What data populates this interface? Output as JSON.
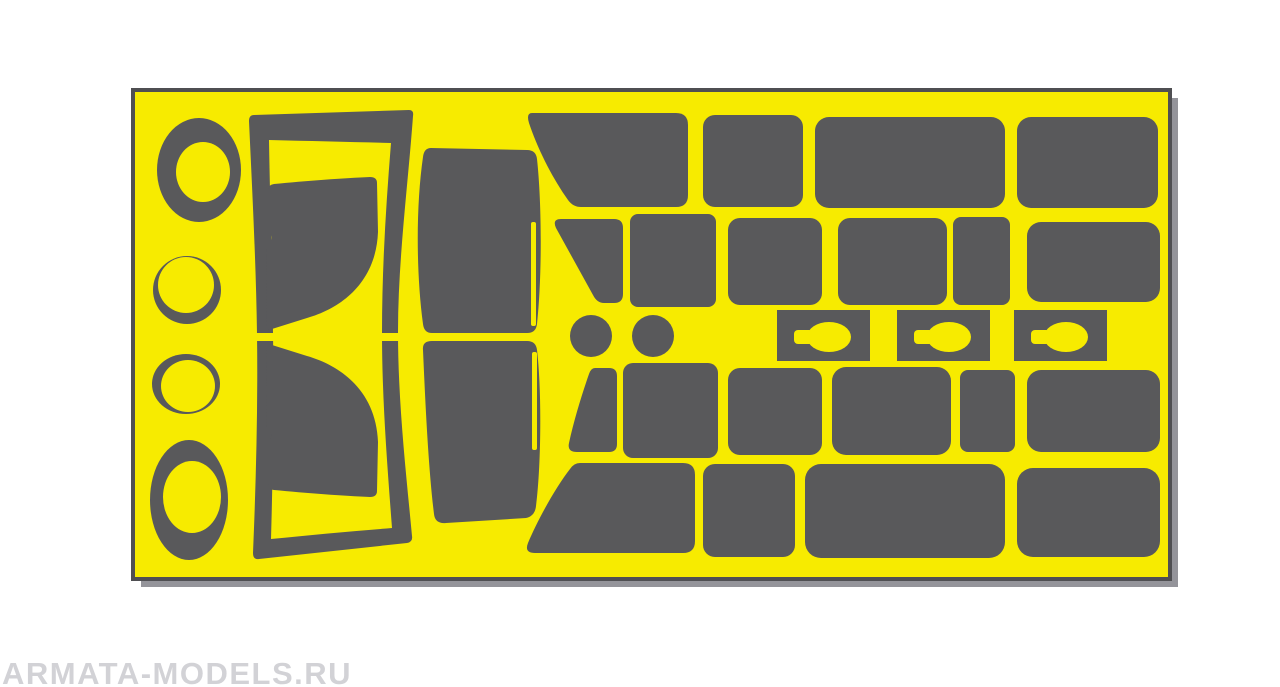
{
  "watermark": {
    "text": "ARMATA-MODELS.RU"
  },
  "palette": {
    "background": "#ffffff",
    "sheet_yellow": "#F7EB00",
    "mask_gray": "#59595B",
    "sheet_outline": "#4F4F52",
    "sheet_shadow": "#94949A",
    "watermark_gray": "#D2D2D6"
  },
  "sheet": {
    "x": 133,
    "y": 90,
    "width": 1037,
    "height": 489,
    "shadow_offset": 7,
    "pieces": [
      {
        "name": "sheet-shadow",
        "kind": "rect",
        "fill": "sheet_shadow",
        "attrs": {
          "x": 141,
          "y": 98,
          "width": 1037,
          "height": 489
        }
      },
      {
        "name": "sheet-backing",
        "kind": "rect",
        "fill": "sheet_yellow",
        "stroke": "sheet_outline",
        "stroke_width": 4,
        "attrs": {
          "x": 133,
          "y": 90,
          "width": 1037,
          "height": 489
        }
      },
      {
        "name": "ring-mask-1-outer",
        "kind": "ellipse",
        "fill": "mask_gray",
        "attrs": {
          "cx": 199,
          "cy": 170,
          "rx": 42,
          "ry": 52
        }
      },
      {
        "name": "ring-mask-1-inner",
        "kind": "ellipse",
        "fill": "sheet_yellow",
        "attrs": {
          "cx": 203,
          "cy": 172,
          "rx": 27,
          "ry": 30
        }
      },
      {
        "name": "ring-mask-2-outer",
        "kind": "ellipse",
        "fill": "mask_gray",
        "attrs": {
          "cx": 187,
          "cy": 290,
          "rx": 34,
          "ry": 34
        }
      },
      {
        "name": "ring-mask-2-inner",
        "kind": "ellipse",
        "fill": "sheet_yellow",
        "attrs": {
          "cx": 186,
          "cy": 285,
          "rx": 28,
          "ry": 28
        }
      },
      {
        "name": "ring-mask-3-outer",
        "kind": "ellipse",
        "fill": "mask_gray",
        "attrs": {
          "cx": 186,
          "cy": 384,
          "rx": 34,
          "ry": 30
        }
      },
      {
        "name": "ring-mask-3-inner",
        "kind": "ellipse",
        "fill": "sheet_yellow",
        "attrs": {
          "cx": 188,
          "cy": 386,
          "rx": 27,
          "ry": 26
        }
      },
      {
        "name": "ring-mask-4-outer",
        "kind": "ellipse",
        "fill": "mask_gray",
        "attrs": {
          "cx": 189,
          "cy": 500,
          "rx": 39,
          "ry": 60
        }
      },
      {
        "name": "ring-mask-4-inner",
        "kind": "ellipse",
        "fill": "sheet_yellow",
        "attrs": {
          "cx": 192,
          "cy": 497,
          "rx": 29,
          "ry": 36
        }
      },
      {
        "name": "door-frame-mask",
        "kind": "path",
        "fill": "mask_gray",
        "attrs": {
          "fill-rule": "evenodd",
          "d": "M 254,115 L 409,110 Q 414,110 413,116 C 408,185 398,260 398,332 C 398,402 406,472 412,536 Q 413,542 407,543 L 259,559 Q 253,560 253,553 C 256,482 258,405 257,334 C 256,262 252,186 249,121 Q 249,115 254,115 Z M 269,140 C 310,141 355,142 391,143 C 386,205 382,268 382,333 C 382,398 387,462 392,528 C 355,531 310,535 271,539 C 273,468 274,400 273,333 C 272,265 270,200 269,140 Z"
        }
      },
      {
        "name": "door-frame-split-left",
        "kind": "rect",
        "fill": "sheet_yellow",
        "attrs": {
          "x": 247,
          "y": 333,
          "width": 30,
          "height": 8
        }
      },
      {
        "name": "door-frame-split-right",
        "kind": "rect",
        "fill": "sheet_yellow",
        "attrs": {
          "x": 376,
          "y": 333,
          "width": 26,
          "height": 8
        }
      },
      {
        "name": "door-window-mask-top",
        "kind": "path",
        "fill": "mask_gray",
        "attrs": {
          "d": "M 274,184 C 305,181 345,178 370,177 Q 377,177 377,183 L 378,232 C 376,282 342,308 307,318 L 272,329 Q 266,331 266,324 L 267,247 Q 275,239 268,229 L 268,190 Q 268,185 274,184 Z"
        }
      },
      {
        "name": "door-window-mask-bottom",
        "kind": "path",
        "fill": "mask_gray",
        "attrs": {
          "d": "M 272,345 L 307,356 C 342,366 376,392 378,442 L 377,491 Q 377,497 370,497 C 345,496 305,493 274,490 Q 268,489 268,484 L 268,444 Q 275,434 267,427 L 266,350 Q 266,343 272,345 Z"
        }
      },
      {
        "name": "windshield-mask-top",
        "kind": "path",
        "fill": "mask_gray",
        "attrs": {
          "d": "M 431,148 L 527,150 Q 536,150 537,159 C 542,205 542,278 537,324 Q 536,333 527,333 L 432,333 Q 424,333 423,324 C 416,272 416,205 423,157 Q 424,148 431,148 Z"
        }
      },
      {
        "name": "windshield-top-slit",
        "kind": "rect",
        "fill": "sheet_yellow",
        "attrs": {
          "x": 531,
          "y": 222,
          "width": 5,
          "height": 104,
          "rx": 2
        }
      },
      {
        "name": "windshield-mask-bottom",
        "kind": "path",
        "fill": "mask_gray",
        "attrs": {
          "d": "M 432,341 L 527,341 Q 536,341 537,350 C 542,392 541,468 536,506 Q 535,516 526,518 L 446,523 Q 435,524 434,514 C 428,465 425,395 423,350 Q 422,341 432,341 Z"
        }
      },
      {
        "name": "windshield-bottom-slit",
        "kind": "rect",
        "fill": "sheet_yellow",
        "attrs": {
          "x": 532,
          "y": 352,
          "width": 5,
          "height": 98,
          "rx": 2
        }
      },
      {
        "name": "quarter-window-mask-row1",
        "kind": "path",
        "fill": "mask_gray",
        "attrs": {
          "d": "M 532,113 L 676,113 Q 688,113 688,125 L 688,195 Q 688,207 676,207 L 581,207 Q 573,207 568,200 C 553,179 538,150 529,123 Q 526,113 532,113 Z"
        }
      },
      {
        "name": "side-window-mask-row1-a",
        "kind": "rect",
        "fill": "mask_gray",
        "attrs": {
          "x": 703,
          "y": 115,
          "width": 100,
          "height": 92,
          "rx": 12
        }
      },
      {
        "name": "side-window-mask-row1-b",
        "kind": "rect",
        "fill": "mask_gray",
        "attrs": {
          "x": 815,
          "y": 117,
          "width": 190,
          "height": 91,
          "rx": 14
        }
      },
      {
        "name": "side-window-mask-row1-c",
        "kind": "rect",
        "fill": "mask_gray",
        "attrs": {
          "x": 1017,
          "y": 117,
          "width": 141,
          "height": 91,
          "rx": 14
        }
      },
      {
        "name": "vent-window-mask-row2",
        "kind": "path",
        "fill": "mask_gray",
        "attrs": {
          "d": "M 561,219 L 614,219 Q 623,219 623,228 L 623,294 Q 623,303 614,303 L 604,303 Q 597,303 593,295 L 556,228 Q 552,219 561,219 Z"
        }
      },
      {
        "name": "side-window-mask-row2-a",
        "kind": "rect",
        "fill": "mask_gray",
        "attrs": {
          "x": 630,
          "y": 214,
          "width": 86,
          "height": 93,
          "rx": 8
        }
      },
      {
        "name": "side-window-mask-row2-b",
        "kind": "rect",
        "fill": "mask_gray",
        "attrs": {
          "x": 728,
          "y": 218,
          "width": 94,
          "height": 87,
          "rx": 12
        }
      },
      {
        "name": "side-window-mask-row2-c",
        "kind": "rect",
        "fill": "mask_gray",
        "attrs": {
          "x": 838,
          "y": 218,
          "width": 109,
          "height": 87,
          "rx": 12
        }
      },
      {
        "name": "side-window-mask-row2-d",
        "kind": "rect",
        "fill": "mask_gray",
        "attrs": {
          "x": 953,
          "y": 217,
          "width": 57,
          "height": 88,
          "rx": 8
        }
      },
      {
        "name": "side-window-mask-row2-e",
        "kind": "rect",
        "fill": "mask_gray",
        "attrs": {
          "x": 1027,
          "y": 222,
          "width": 133,
          "height": 80,
          "rx": 14
        }
      },
      {
        "name": "round-mask-small-a",
        "kind": "ellipse",
        "fill": "mask_gray",
        "attrs": {
          "cx": 591,
          "cy": 336,
          "rx": 21,
          "ry": 21
        }
      },
      {
        "name": "round-mask-small-b",
        "kind": "ellipse",
        "fill": "mask_gray",
        "attrs": {
          "cx": 653,
          "cy": 336,
          "rx": 21,
          "ry": 21
        }
      },
      {
        "name": "keyhole-plate-mask-1",
        "kind": "rect",
        "fill": "mask_gray",
        "attrs": {
          "x": 777,
          "y": 310,
          "width": 93,
          "height": 51
        }
      },
      {
        "name": "keyhole-cutout-stem-1",
        "kind": "rect",
        "fill": "sheet_yellow",
        "attrs": {
          "x": 794,
          "y": 330,
          "width": 19,
          "height": 14,
          "rx": 4
        }
      },
      {
        "name": "keyhole-cutout-bow-1",
        "kind": "ellipse",
        "fill": "sheet_yellow",
        "attrs": {
          "cx": 829,
          "cy": 337,
          "rx": 22,
          "ry": 15
        }
      },
      {
        "name": "keyhole-plate-mask-2",
        "kind": "rect",
        "fill": "mask_gray",
        "attrs": {
          "x": 897,
          "y": 310,
          "width": 93,
          "height": 51
        }
      },
      {
        "name": "keyhole-cutout-stem-2",
        "kind": "rect",
        "fill": "sheet_yellow",
        "attrs": {
          "x": 914,
          "y": 330,
          "width": 19,
          "height": 14,
          "rx": 4
        }
      },
      {
        "name": "keyhole-cutout-bow-2",
        "kind": "ellipse",
        "fill": "sheet_yellow",
        "attrs": {
          "cx": 949,
          "cy": 337,
          "rx": 22,
          "ry": 15
        }
      },
      {
        "name": "keyhole-plate-mask-3",
        "kind": "rect",
        "fill": "mask_gray",
        "attrs": {
          "x": 1014,
          "y": 310,
          "width": 93,
          "height": 51
        }
      },
      {
        "name": "keyhole-cutout-stem-3",
        "kind": "rect",
        "fill": "sheet_yellow",
        "attrs": {
          "x": 1031,
          "y": 330,
          "width": 19,
          "height": 14,
          "rx": 4
        }
      },
      {
        "name": "keyhole-cutout-bow-3",
        "kind": "ellipse",
        "fill": "sheet_yellow",
        "attrs": {
          "cx": 1066,
          "cy": 337,
          "rx": 22,
          "ry": 15
        }
      },
      {
        "name": "vent-window-mask-row4",
        "kind": "path",
        "fill": "mask_gray",
        "attrs": {
          "d": "M 595,368 L 609,368 Q 617,368 617,376 L 617,444 Q 617,452 609,452 L 577,452 Q 567,452 569,443 C 574,420 582,394 589,374 Q 591,368 595,368 Z"
        }
      },
      {
        "name": "side-window-mask-row4-a",
        "kind": "rect",
        "fill": "mask_gray",
        "attrs": {
          "x": 623,
          "y": 363,
          "width": 95,
          "height": 95,
          "rx": 10
        }
      },
      {
        "name": "side-window-mask-row4-b",
        "kind": "rect",
        "fill": "mask_gray",
        "attrs": {
          "x": 728,
          "y": 368,
          "width": 94,
          "height": 87,
          "rx": 12
        }
      },
      {
        "name": "side-window-mask-row4-c",
        "kind": "rect",
        "fill": "mask_gray",
        "attrs": {
          "x": 832,
          "y": 367,
          "width": 119,
          "height": 88,
          "rx": 14
        }
      },
      {
        "name": "side-window-mask-row4-d",
        "kind": "rect",
        "fill": "mask_gray",
        "attrs": {
          "x": 960,
          "y": 370,
          "width": 55,
          "height": 82,
          "rx": 8
        }
      },
      {
        "name": "side-window-mask-row4-e",
        "kind": "rect",
        "fill": "mask_gray",
        "attrs": {
          "x": 1027,
          "y": 370,
          "width": 133,
          "height": 82,
          "rx": 14
        }
      },
      {
        "name": "quarter-window-mask-row5",
        "kind": "path",
        "fill": "mask_gray",
        "attrs": {
          "d": "M 580,463 L 683,463 Q 695,463 695,475 L 695,541 Q 695,553 683,553 L 535,553 Q 524,553 528,543 C 538,519 556,487 570,469 Q 574,463 580,463 Z"
        }
      },
      {
        "name": "side-window-mask-row5-a",
        "kind": "rect",
        "fill": "mask_gray",
        "attrs": {
          "x": 703,
          "y": 464,
          "width": 92,
          "height": 93,
          "rx": 12
        }
      },
      {
        "name": "side-window-mask-row5-b",
        "kind": "rect",
        "fill": "mask_gray",
        "attrs": {
          "x": 805,
          "y": 464,
          "width": 200,
          "height": 94,
          "rx": 16
        }
      },
      {
        "name": "side-window-mask-row5-c",
        "kind": "rect",
        "fill": "mask_gray",
        "attrs": {
          "x": 1017,
          "y": 468,
          "width": 143,
          "height": 89,
          "rx": 16
        }
      }
    ]
  }
}
